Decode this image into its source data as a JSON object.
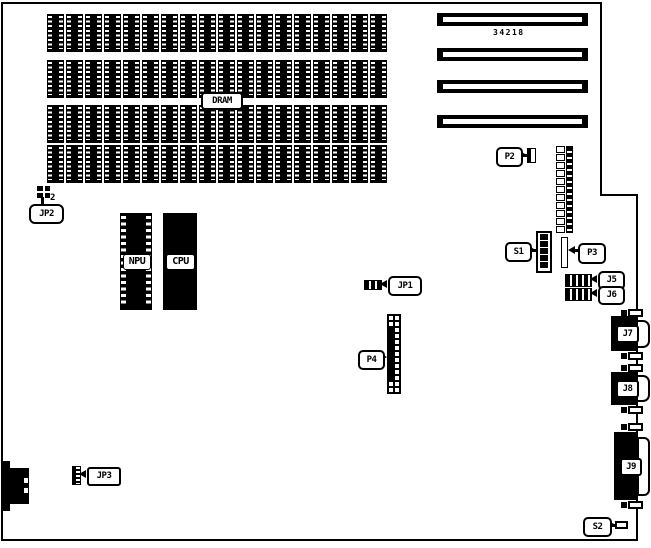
{
  "board": {
    "part_number": "34218",
    "colors": {
      "ink": "#000000",
      "background": "#ffffff"
    }
  },
  "labels": {
    "dram": "DRAM",
    "npu": "NPU",
    "cpu": "CPU",
    "jp1": "JP1",
    "jp2": "JP2",
    "jp2_pin": "2",
    "jp3": "JP3",
    "p2": "P2",
    "p3": "P3",
    "p4": "P4",
    "s1": "S1",
    "s2": "S2",
    "j5": "J5",
    "j6": "J6",
    "j7": "J7",
    "j8": "J8",
    "j9": "J9"
  },
  "memory": {
    "rows": 4,
    "chips_per_row": 18
  },
  "expansion_slots": {
    "count": 4
  }
}
